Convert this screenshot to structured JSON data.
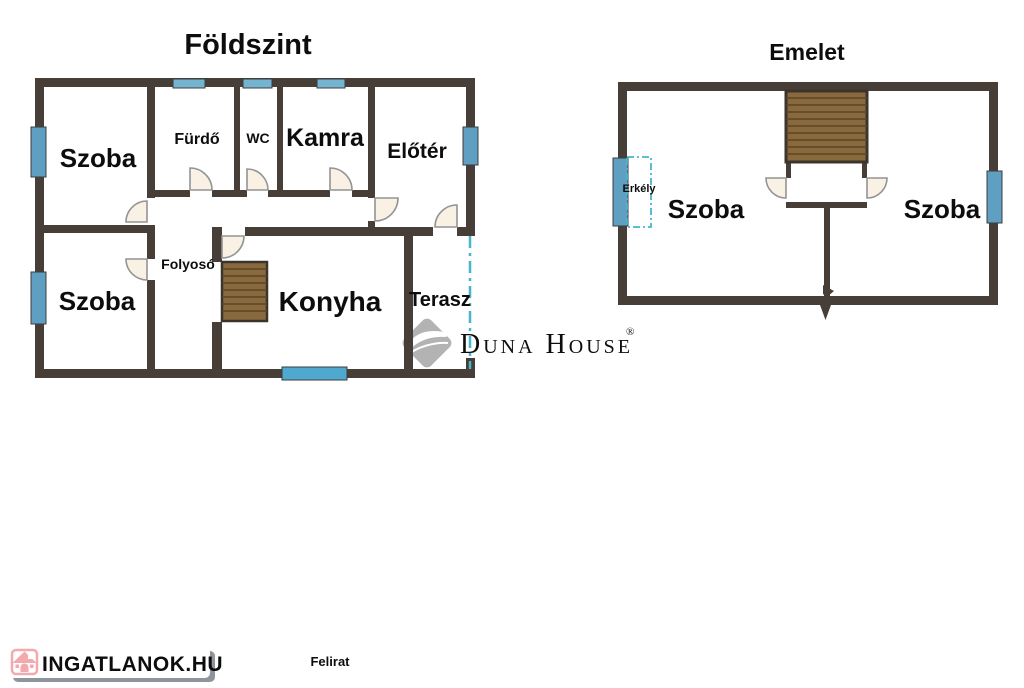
{
  "page": {
    "caption": "Felirat"
  },
  "colors": {
    "wall": "#473f37",
    "window_side": "#5fa0c2",
    "window_top": "#74b4d0",
    "door_fill": "#f8f1e4",
    "door_stroke": "#949494",
    "stairs_fill": "#8a6a3c",
    "stairs_stripe": "#57442a",
    "dashed_cyan": "#45b6cc",
    "watermark_gray": "#b5b5b5",
    "logo_pink": "#f2aaaf",
    "logo_text_pink": "#f3b2b7",
    "logo_shadow": "#8e959c"
  },
  "ground_floor": {
    "title": "Földszint",
    "rooms": {
      "szoba_top": "Szoba",
      "furdo": "Fürdő",
      "wc": "WC",
      "kamra": "Kamra",
      "eloter": "Előtér",
      "szoba_bottom": "Szoba",
      "folyoso": "Folyosó",
      "konyha": "Konyha",
      "terasz": "Terasz"
    }
  },
  "upper_floor": {
    "title": "Emelet",
    "rooms": {
      "erkely": "Erkély",
      "szoba_left": "Szoba",
      "szoba_right": "Szoba"
    }
  },
  "watermark": {
    "brand": "Duna House",
    "registered": "®"
  },
  "footer_logo": {
    "text": "INGATLANOK.HU"
  }
}
